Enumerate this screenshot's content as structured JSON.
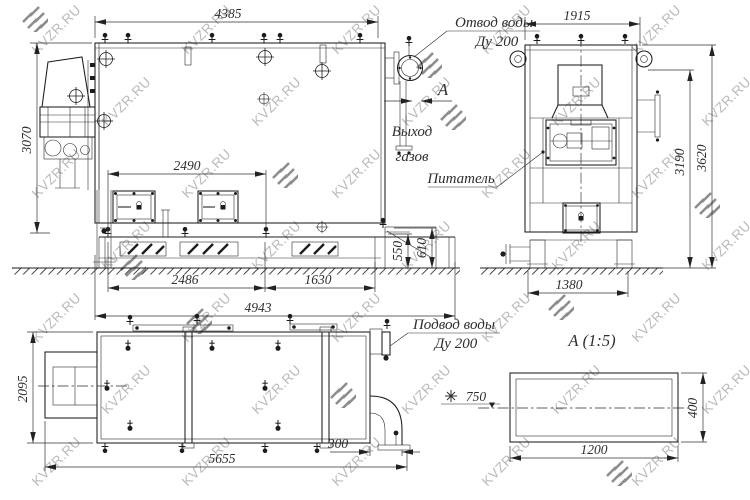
{
  "watermark": {
    "text": "KVZR.RU"
  },
  "annotations": {
    "water_outlet": {
      "line1": "Отвод воды",
      "line2": "Ду 200"
    },
    "gas_outlet": {
      "line1": "Выход",
      "line2": "газов"
    },
    "section_arrow": "А",
    "feeder": "Питатель",
    "water_inlet": {
      "line1": "Подвод воды",
      "line2": "Ду 200"
    },
    "detail_title": "А  (1:5)",
    "level_mark": "750"
  },
  "dimensions": {
    "front": {
      "top_width": "4385",
      "height": "3070",
      "door_span": "2490",
      "grate_span": "2486",
      "ash_span": "1630",
      "base_width": "4943",
      "pan_height": "550",
      "duct_height": "610"
    },
    "side": {
      "top_width": "1915",
      "height_to_duct": "3190",
      "overall_height": "3620",
      "base_width": "1380"
    },
    "plan": {
      "depth": "2095",
      "overall_length": "5655",
      "pipe_offset": "300"
    },
    "detail": {
      "width": "1200",
      "height": "400"
    }
  }
}
